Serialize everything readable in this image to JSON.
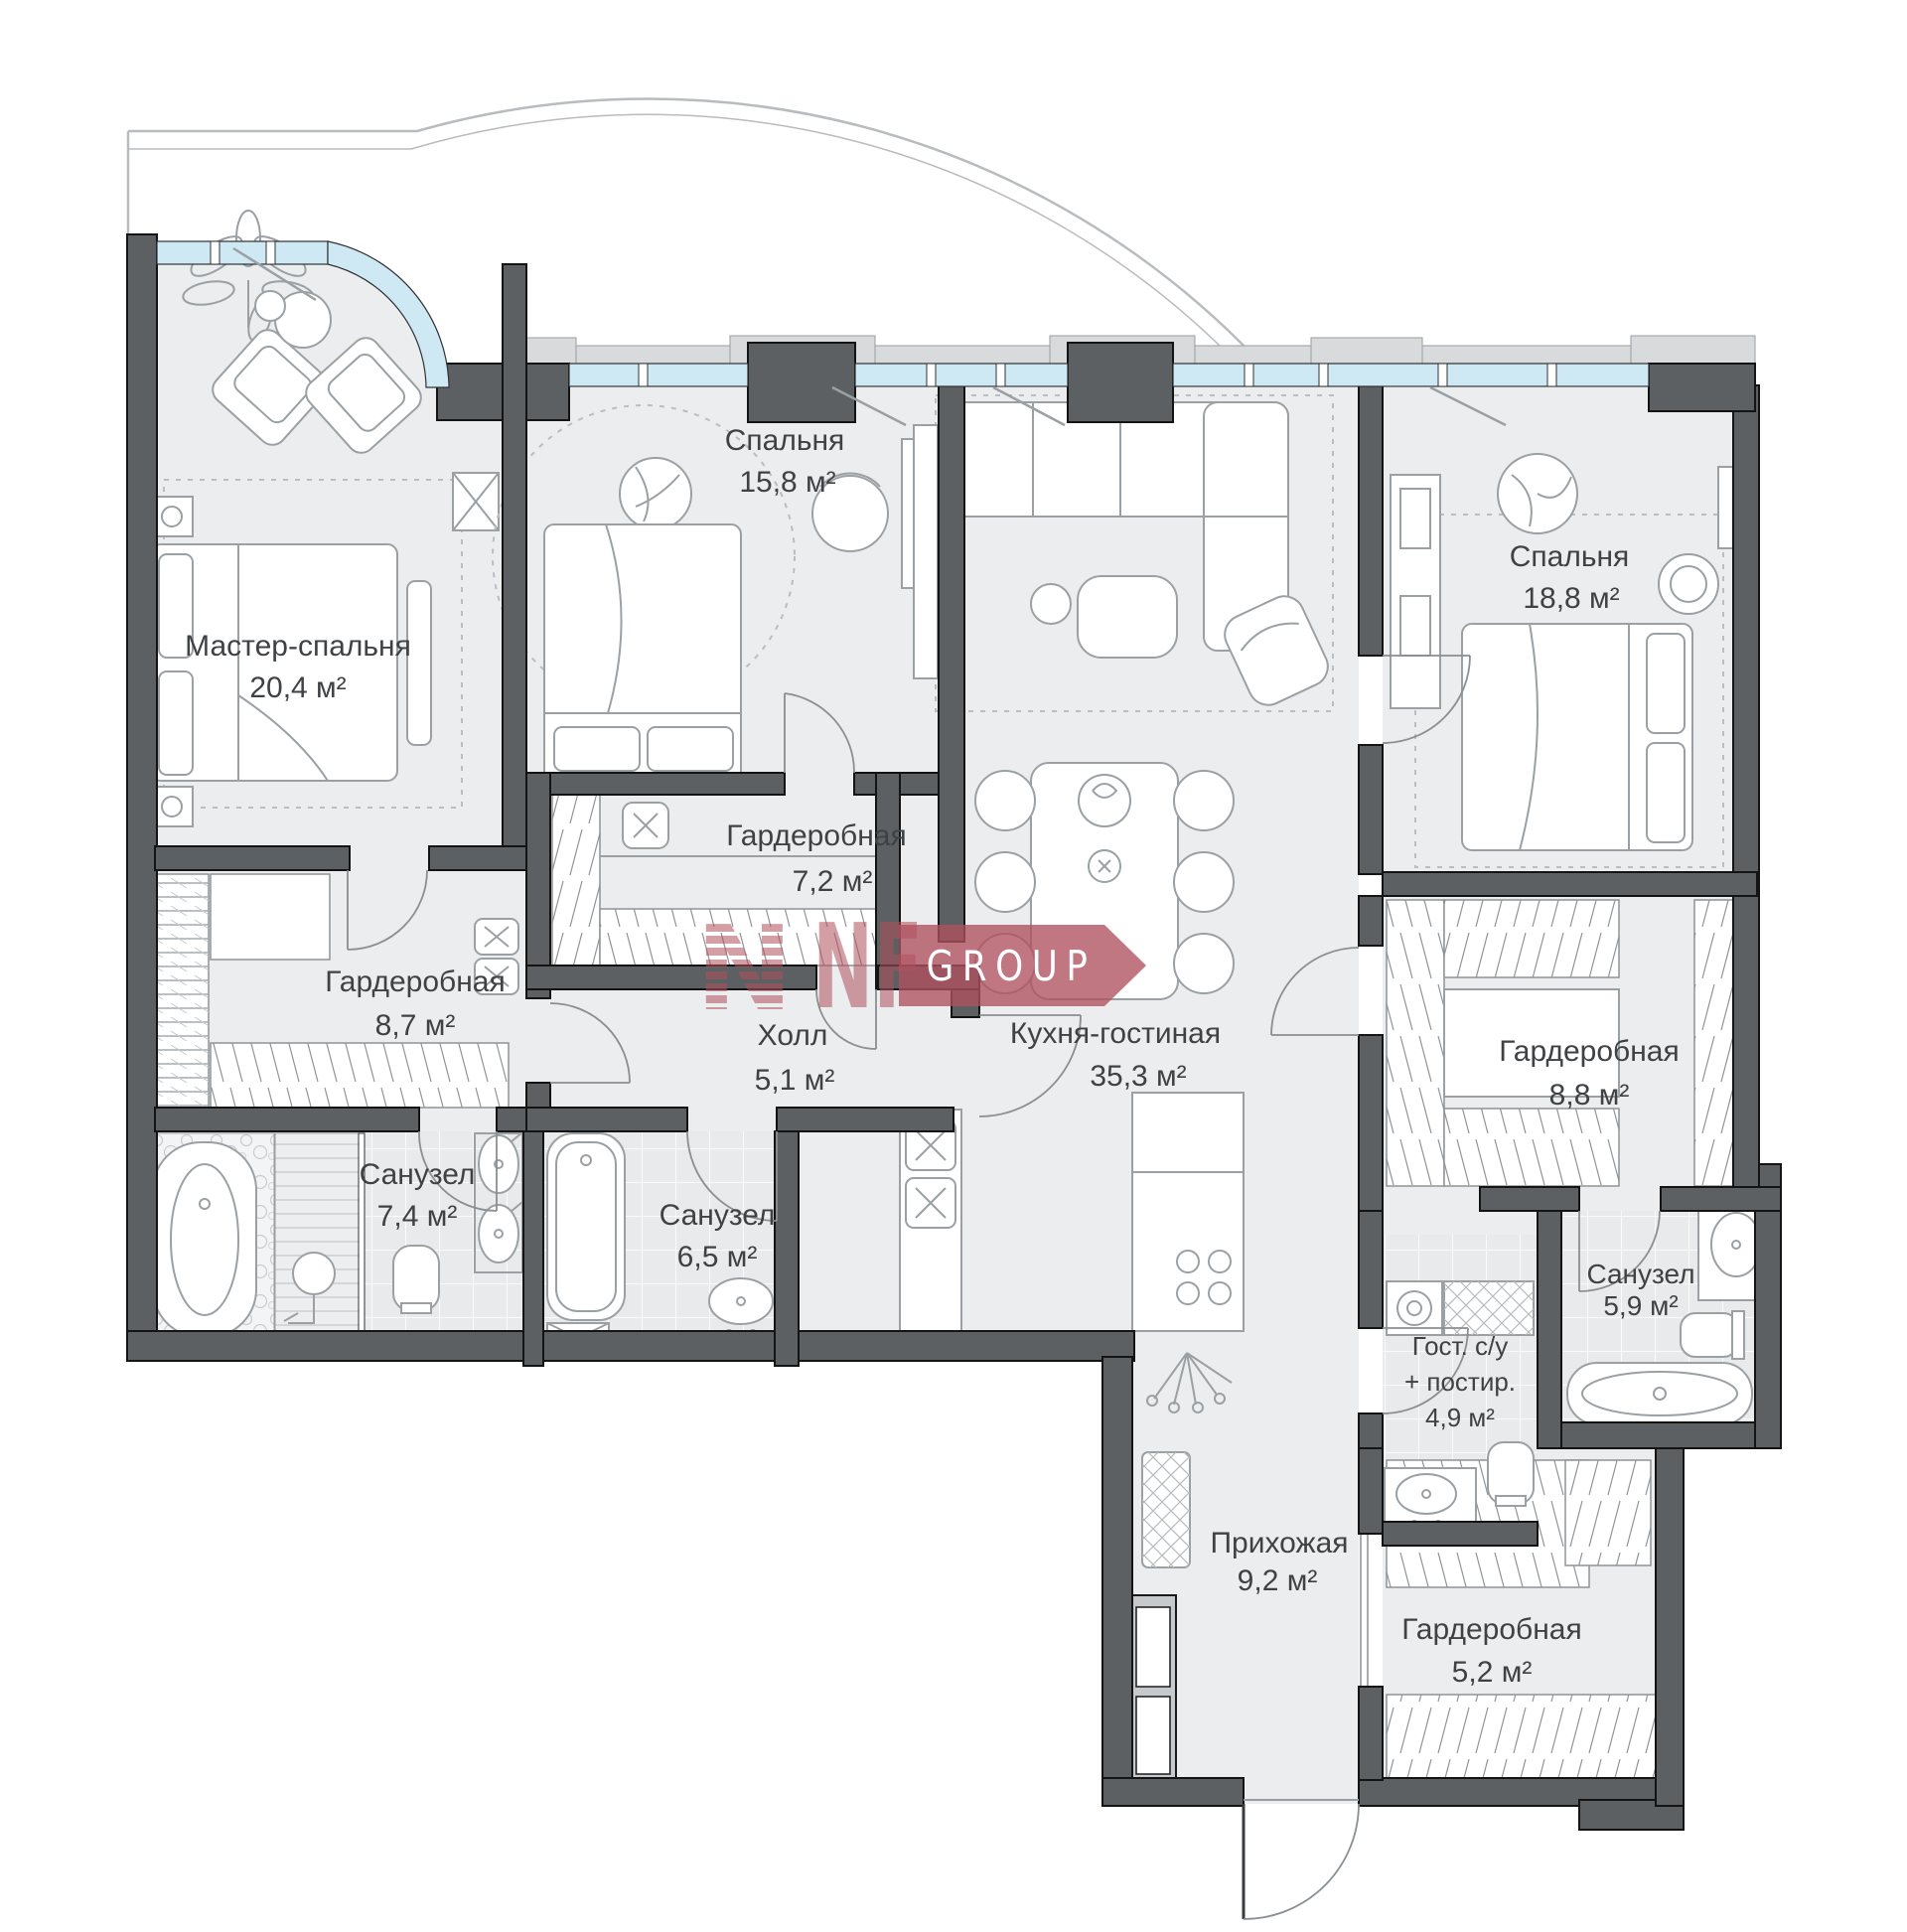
{
  "plan": {
    "type": "apartment-floor-plan",
    "language": "ru",
    "total_rooms_labeled": 14
  },
  "watermark": {
    "brand": "NF",
    "brand_striped_letter": "N",
    "suffix": "GROUP"
  },
  "rooms": [
    {
      "id": "master-bedroom",
      "name": "Мастер-спальня",
      "area": "20,4 м²"
    },
    {
      "id": "bedroom-2",
      "name": "Спальня",
      "area": "15,8 м²"
    },
    {
      "id": "bedroom-3",
      "name": "Спальня",
      "area": "18,8 м²"
    },
    {
      "id": "wardrobe-7-2",
      "name": "Гардеробная",
      "area": "7,2 м²"
    },
    {
      "id": "wardrobe-8-7",
      "name": "Гардеробная",
      "area": "8,7 м²"
    },
    {
      "id": "hall",
      "name": "Холл",
      "area": "5,1 м²"
    },
    {
      "id": "kitchen-living",
      "name": "Кухня-гостиная",
      "area": "35,3 м²"
    },
    {
      "id": "wardrobe-8-8",
      "name": "Гардеробная",
      "area": "8,8 м²"
    },
    {
      "id": "bathroom-7-4",
      "name": "Санузел",
      "area": "7,4 м²"
    },
    {
      "id": "bathroom-6-5",
      "name": "Санузел",
      "area": "6,5 м²"
    },
    {
      "id": "guest-wc-laundry",
      "name": "Гост. с/у",
      "name_line2": "+ постир.",
      "area": "4,9 м²"
    },
    {
      "id": "bathroom-5-9",
      "name": "Санузел",
      "area": "5,9 м²"
    },
    {
      "id": "entry-hall",
      "name": "Прихожая",
      "area": "9,2 м²"
    },
    {
      "id": "wardrobe-5-2",
      "name": "Гардеробная",
      "area": "5,2 м²"
    }
  ],
  "colors": {
    "wall": "#5d6063",
    "window_glass": "#cfe9f4",
    "floor": "#ebedee",
    "tile": "#e8eaeb",
    "pilaster": "#d8dadb",
    "watermark": "#b0515d",
    "label": "#3f4245",
    "furniture_line": "#9aa0a4",
    "balcony_line": "#b8bcbe"
  }
}
